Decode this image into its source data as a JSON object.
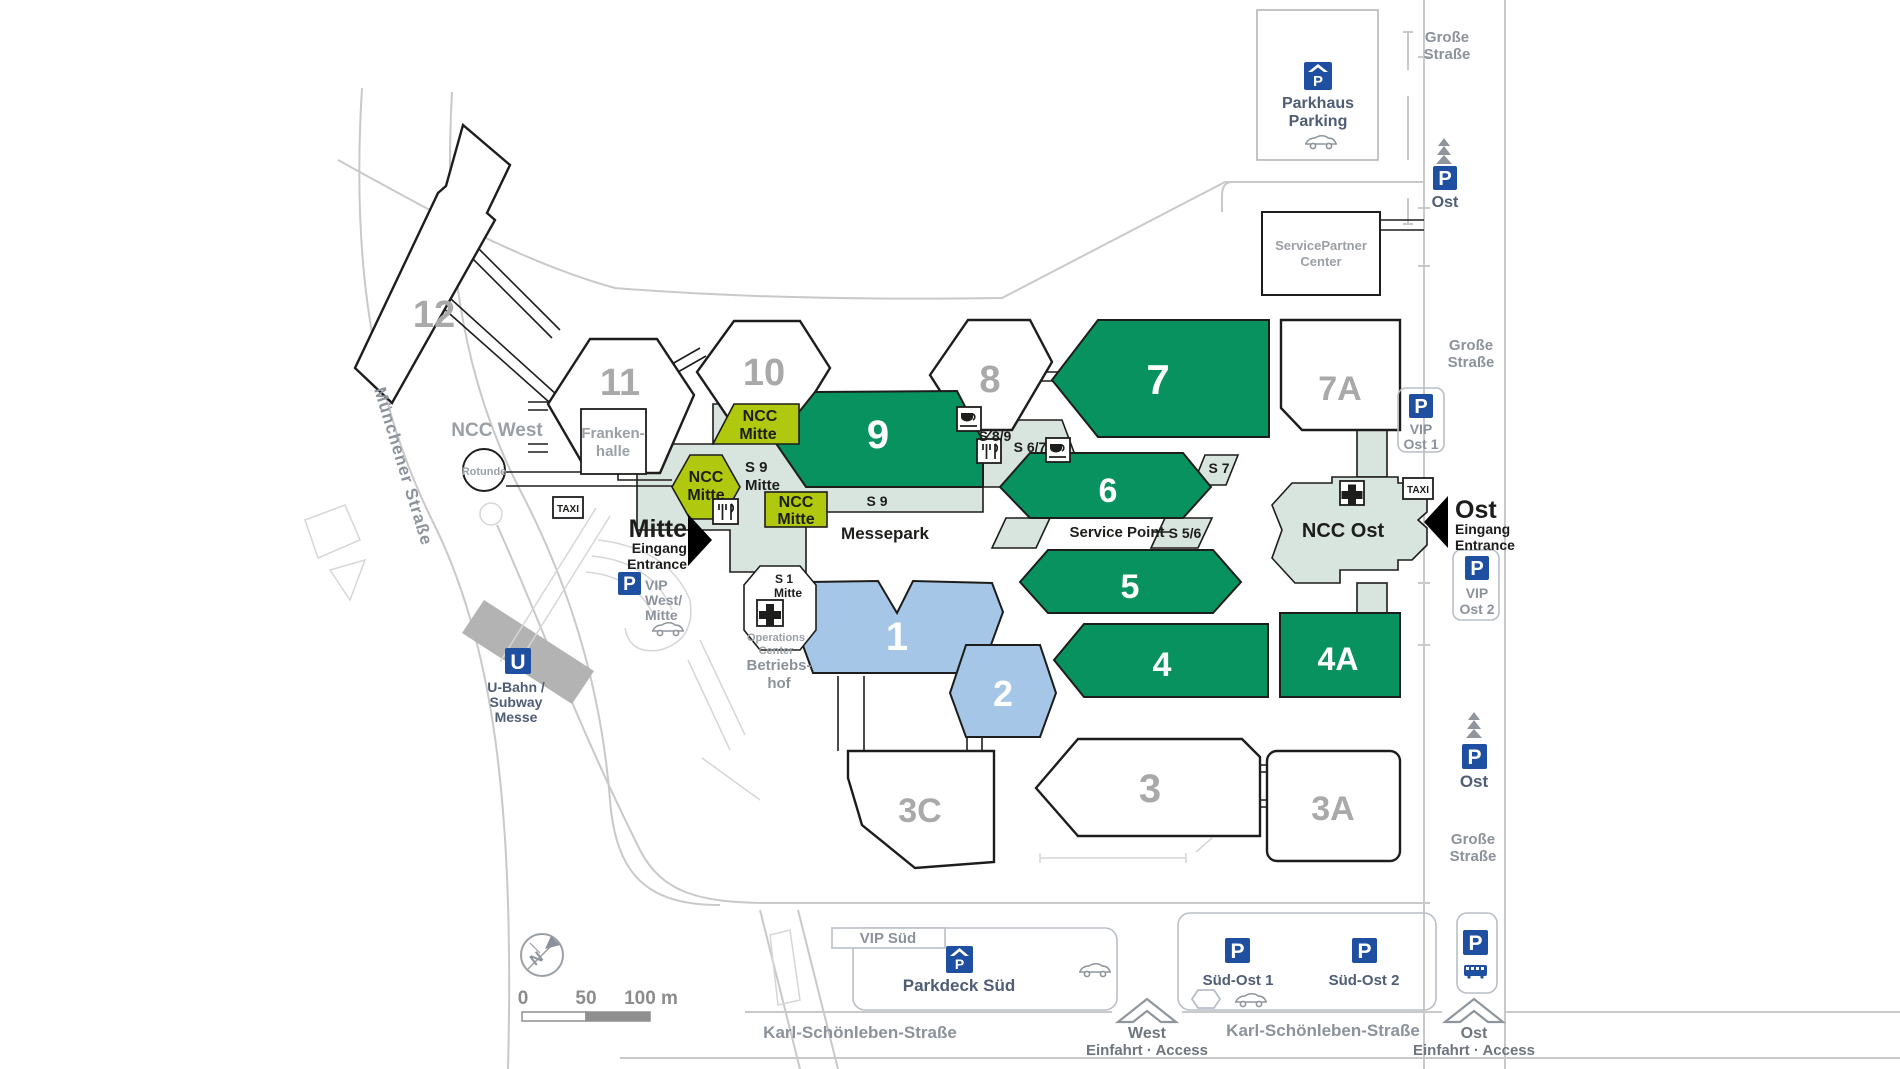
{
  "halls": {
    "h12": "12",
    "h11": "11",
    "h10": "10",
    "h9": "9",
    "h8": "8",
    "h7": "7",
    "h7a": "7A",
    "h6": "6",
    "h5": "5",
    "h4": "4",
    "h4a": "4A",
    "h1": "1",
    "h2": "2",
    "h3": "3",
    "h3a": "3A",
    "h3c": "3C"
  },
  "buildings": {
    "ncc_west": "NCC West",
    "rotunde": "Rotunde",
    "frankenhalle_l1": "Franken-",
    "frankenhalle_l2": "halle",
    "ncc_mitte_l1": "NCC",
    "ncc_mitte_l2": "Mitte",
    "ncc_ost": "NCC Ost",
    "messepark": "Messepark",
    "servicepartner_l1": "ServicePartner",
    "servicepartner_l2": "Center",
    "parkhaus_l1": "Parkhaus",
    "parkhaus_l2": "Parking",
    "operations_l1": "Operations",
    "operations_l2": "Center",
    "betriebshof_l1": "Betriebs-",
    "betriebshof_l2": "hof"
  },
  "streets": {
    "muenchener": "Münchener Straße",
    "karl": "Karl-Schönleben-Straße",
    "grosse_l1": "Große",
    "grosse_l2": "Straße"
  },
  "transit": {
    "u_label": "U",
    "ubahn_l1": "U-Bahn /",
    "ubahn_l2": "Subway",
    "ubahn_l3": "Messe",
    "taxi_label": "TAXI"
  },
  "entrances": {
    "mitte_name": "Mitte",
    "mitte_l1": "Eingang",
    "mitte_l2": "Entrance",
    "ost_name": "Ost",
    "ost_l1": "Eingang",
    "ost_l2": "Entrance",
    "west_access_name": "West",
    "ost_access_name": "Ost",
    "access_sub": "Einfahrt · Access"
  },
  "parking": {
    "p_label": "P",
    "ost_top": "Ost",
    "ost_mid": "Ost",
    "vip_west_l1": "VIP",
    "vip_west_l2": "West/",
    "vip_west_l3": "Mitte",
    "vip_ost1_l1": "VIP",
    "vip_ost1_l2": "Ost 1",
    "vip_ost2_l1": "VIP",
    "vip_ost2_l2": "Ost 2",
    "vip_sued": "VIP Süd",
    "parkdeck_sued": "Parkdeck Süd",
    "suedost1": "Süd-Ost 1",
    "suedost2": "Süd-Ost 2"
  },
  "service": {
    "service_point": "Service Point",
    "s9m_l1": "S 9",
    "s9m_l2": "Mitte",
    "s9": "S 9",
    "s89": "S 8/9",
    "s67": "S 6/7",
    "s7": "S 7",
    "s56": "S 5/6",
    "s1_l1": "S 1",
    "s1_l2": "Mitte"
  },
  "scalebar": {
    "zero": "0",
    "fifty": "50",
    "hundred": "100 m",
    "north": "N"
  },
  "icons": [
    "parkhaus-roof-icon",
    "parking-p-icon",
    "taxi-icon",
    "first-aid-icon",
    "coffee-icon",
    "restaurant-icon",
    "car-icon",
    "bus-icon",
    "tree-icon",
    "u-bahn-icon",
    "entrance-arrow-icon",
    "access-arrow-icon",
    "compass-icon"
  ],
  "colors": {
    "hall_green": "#08925f",
    "hall_blue": "#a5c6e6",
    "ncc_yellow": "#b0c90e",
    "corridor_teal": "#d8e5df",
    "parking_blue": "#1f4fa0",
    "outline": "#1d1d1b",
    "road_gray": "#c9c9c9",
    "number_gray": "#a9a9a9",
    "street_gray": "#8c929c",
    "label_slate": "#4f5d75"
  }
}
